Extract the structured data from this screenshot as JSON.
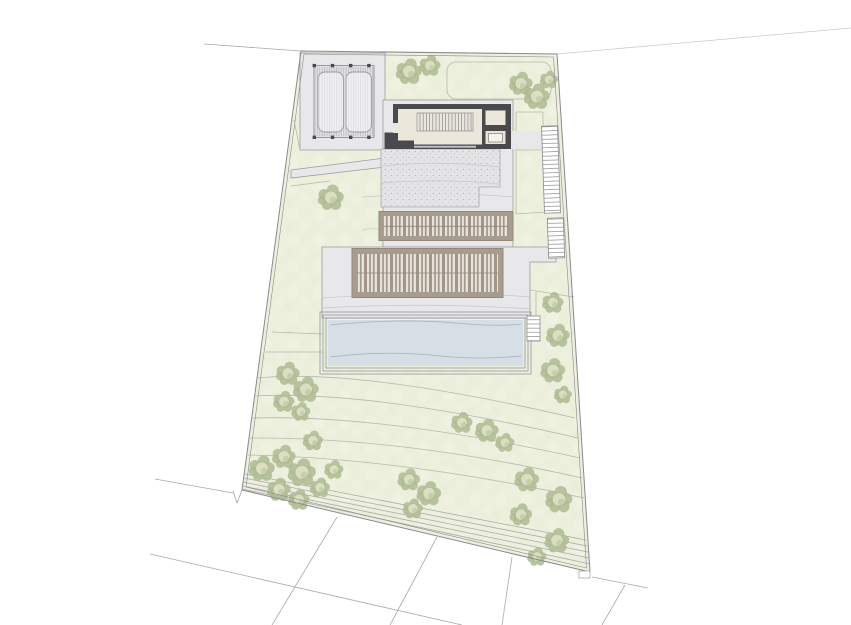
{
  "document": {
    "title": "Architectural site plan - top-down roof plan with pool and terraced garden",
    "visible_text": ""
  },
  "palette": {
    "paper": "#ffffff",
    "terrain": "#edefdd",
    "terrain_line": "#b4b9a9",
    "hardscape": "#e8e8ea",
    "hardscape_line": "#9b9ba1",
    "boundary": "#8a8a8f",
    "parcel_line": "#a9a9ad",
    "wall": "#4a4a4c",
    "floor": "#ebe7db",
    "pergola": "#a89c8e",
    "pergola_frame": "#93887a",
    "pergola_deck": "#e6e3da",
    "pool_water": "#d6dee6",
    "pool_line": "#8f959c",
    "tree_dark": "#adbb92",
    "tree_light": "#dadfc1",
    "tree_top_dark": "#c7d0a6",
    "tree_top_light": "#e6e9cd",
    "stipple_dot": "#9a9a9e",
    "stair_line": "#8b8b90",
    "hatch_line": "#b2b2b8",
    "faint_line": "#c8c8cb"
  },
  "plan": {
    "type": "architectural-site-plan",
    "view": "top-down",
    "features": [
      {
        "name": "site-boundary",
        "desc": "irregular quadrilateral parcel with double outline"
      },
      {
        "name": "access-road-line",
        "desc": "faint road edge lines beyond the top boundary"
      },
      {
        "name": "carport-canopy",
        "desc": "hatched slatted canopy over two parking bays, top-left"
      },
      {
        "name": "house",
        "desc": "rectangular building with dark walls, internal stair and two service rooms with skylight"
      },
      {
        "name": "gravel-terrace",
        "desc": "stippled terrace south of the house"
      },
      {
        "name": "pergola-upper",
        "desc": "narrow timber-louvred roof band"
      },
      {
        "name": "pergola-lower",
        "desc": "large timber-louvred roof band"
      },
      {
        "name": "swimming-pool",
        "desc": "rectangular pool with concentric coping lines"
      },
      {
        "name": "garden-stairs",
        "desc": "three stair flights along the east side"
      },
      {
        "name": "terraced-garden",
        "desc": "contoured lawn with clustered trees"
      },
      {
        "name": "neighbor-parcels",
        "desc": "empty parcels with thin division lines to the south"
      }
    ],
    "tree_count": 28,
    "trees": [
      [
        409,
        72,
        1.15,
        "top"
      ],
      [
        430,
        66,
        0.95,
        "top"
      ],
      [
        521,
        84,
        1.05,
        "top"
      ],
      [
        537,
        97,
        1.15,
        "top"
      ],
      [
        549,
        80,
        0.8,
        "top"
      ],
      [
        331,
        198,
        1.15,
        "top"
      ],
      [
        553,
        303,
        0.95
      ],
      [
        558,
        336,
        1.05
      ],
      [
        553,
        371,
        1.1
      ],
      [
        563,
        395,
        0.8
      ],
      [
        288,
        374,
        1.05
      ],
      [
        306,
        390,
        1.15
      ],
      [
        284,
        402,
        0.95
      ],
      [
        301,
        412,
        0.85
      ],
      [
        262,
        469,
        1.15
      ],
      [
        284,
        457,
        1.05
      ],
      [
        302,
        473,
        1.25
      ],
      [
        279,
        490,
        1.05
      ],
      [
        299,
        500,
        0.95
      ],
      [
        320,
        488,
        0.9
      ],
      [
        334,
        470,
        0.85
      ],
      [
        313,
        441,
        0.9
      ],
      [
        409,
        480,
        1.0
      ],
      [
        429,
        494,
        1.1
      ],
      [
        413,
        509,
        0.9
      ],
      [
        462,
        423,
        0.95
      ],
      [
        487,
        431,
        1.05
      ],
      [
        505,
        443,
        0.85
      ],
      [
        527,
        480,
        1.1
      ],
      [
        559,
        500,
        1.2
      ],
      [
        521,
        515,
        1.0
      ],
      [
        557,
        541,
        1.1
      ],
      [
        537,
        557,
        0.85
      ]
    ]
  }
}
